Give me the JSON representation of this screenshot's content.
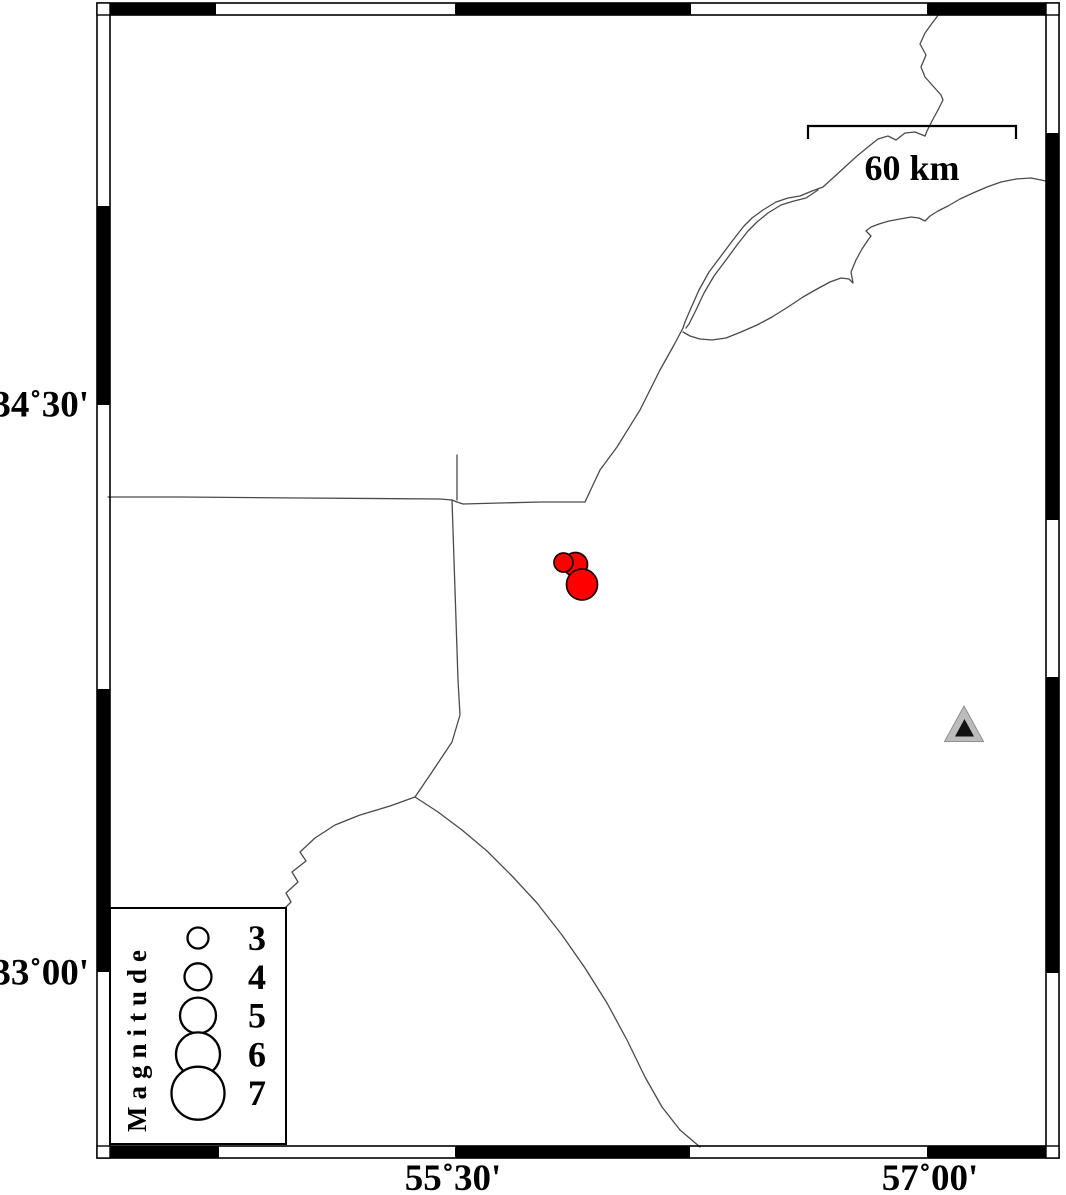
{
  "figure": {
    "type": "seismicity-map",
    "frame_labels": {
      "lat_top": "34˚30'",
      "lat_bottom": "33˚00'",
      "lon_left": "55˚30'",
      "lon_right": "57˚00'"
    },
    "scale_bar": {
      "label": "60 km"
    },
    "legend": {
      "title": "Magnitude",
      "entries": [
        {
          "magnitude": "3",
          "radius_px": 10.5
        },
        {
          "magnitude": "4",
          "radius_px": 13.5
        },
        {
          "magnitude": "5",
          "radius_px": 18
        },
        {
          "magnitude": "6",
          "radius_px": 22
        },
        {
          "magnitude": "7",
          "radius_px": 26.5
        }
      ]
    },
    "epicenters": [
      {
        "x": 575.5,
        "y": 564.5,
        "r": 12
      },
      {
        "x": 563.5,
        "y": 562.5,
        "r": 9.5
      },
      {
        "x": 582.0,
        "y": 584.5,
        "r": 15.5
      }
    ],
    "station": {
      "x": 964,
      "y": 728
    },
    "colors": {
      "epicenter": "#fe0000",
      "epicenter_outline": "#1a0000",
      "station_outer": "#bcbcbc",
      "station_inner": "#111111",
      "boundary_line": "#4a4a4a",
      "frame": "#000000"
    }
  }
}
